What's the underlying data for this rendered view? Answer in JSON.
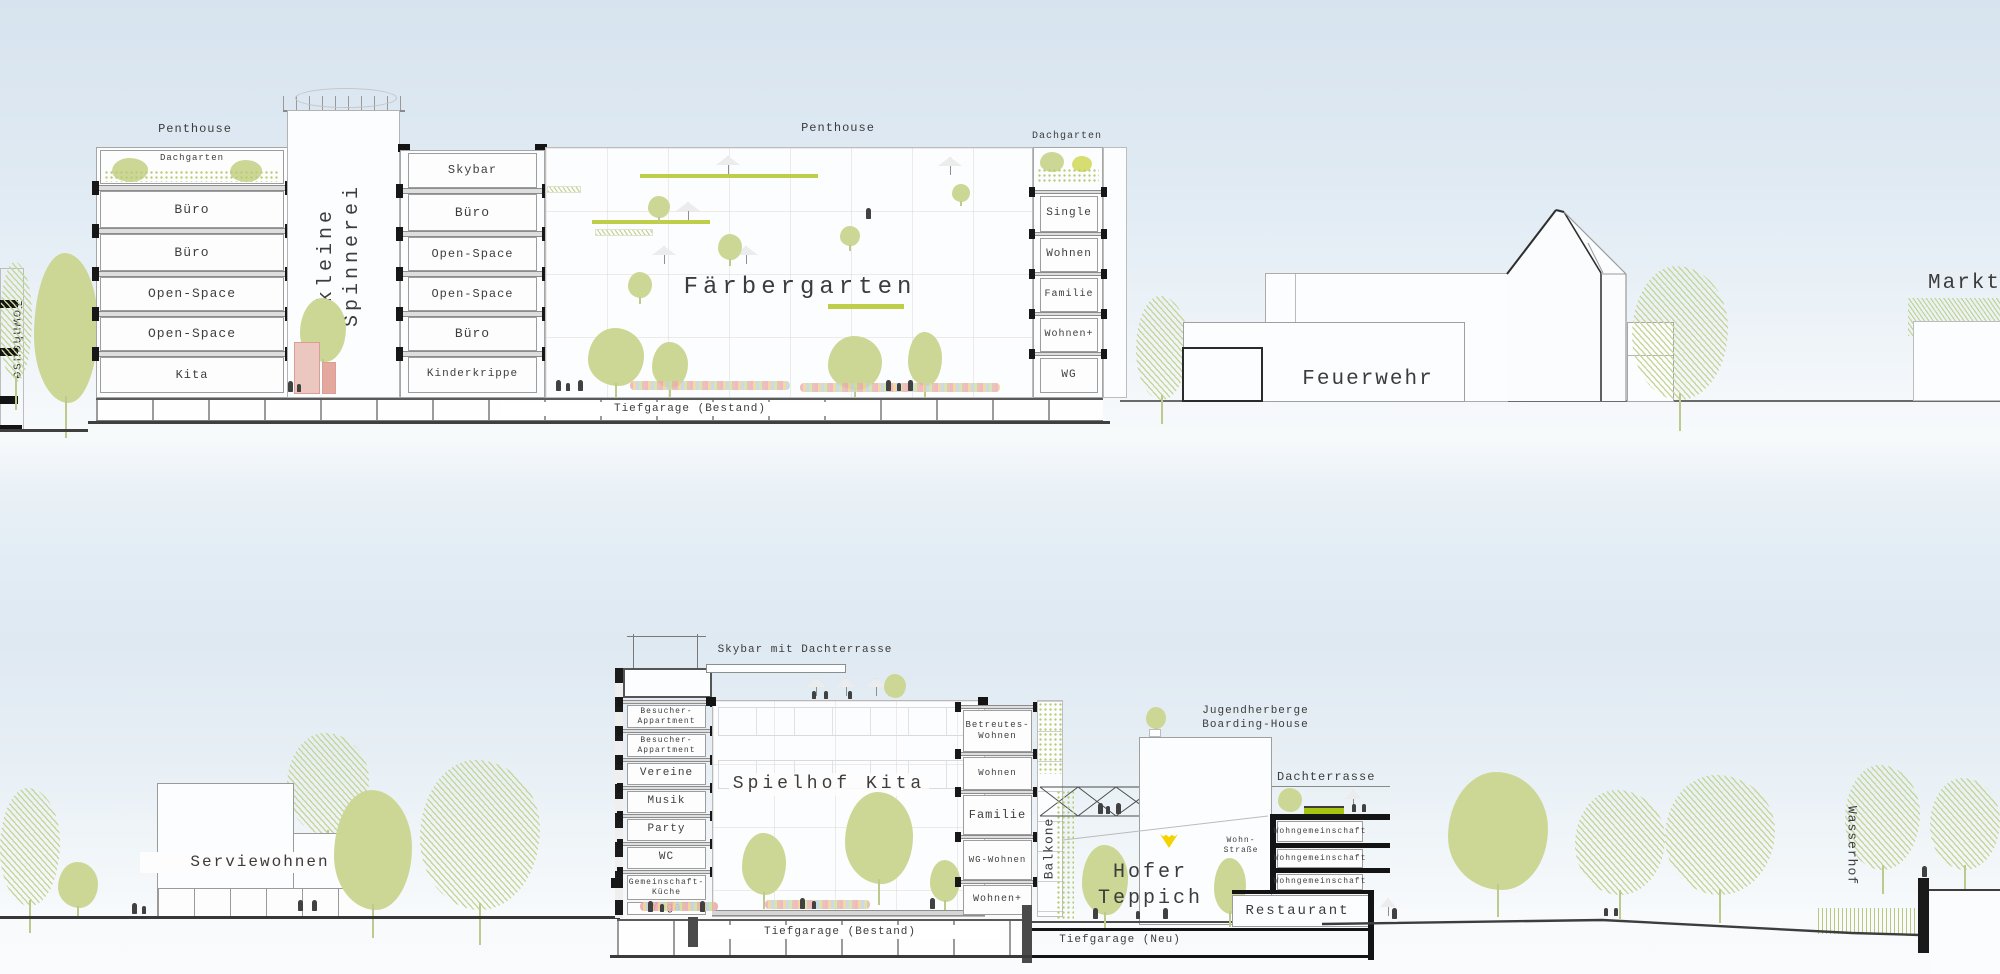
{
  "top": {
    "townhouse": "Townhouse",
    "penthouse_left": "Penthouse",
    "left_tower_floors": [
      "Dachgarten",
      "Büro",
      "Büro",
      "Open-Space",
      "Open-Space",
      "Kita"
    ],
    "spinnerei": "kleine\nSpinnerei",
    "mid_tower_floors": [
      "Skybar",
      "Büro",
      "Open-Space",
      "Open-Space",
      "Büro",
      "Kinderkrippe"
    ],
    "penthouse_center": "Penthouse",
    "hall": "Färbergarten",
    "dachgarten_right": "Dachgarten",
    "right_tower_floors": [
      "Single",
      "Wohnen",
      "Familie",
      "Wohnen+",
      "WG"
    ],
    "tiefgarage": "Tiefgarage (Bestand)",
    "feuerwehr": "Feuerwehr",
    "markt": "Markt"
  },
  "bottom": {
    "serviewohnen": "Serviewohnen",
    "skybar": "Skybar mit Dachterrasse",
    "left_tower_floors": [
      "Besucher-\nAppartment",
      "Besucher-\nAppartment",
      "Vereine",
      "Musik",
      "Party",
      "WC",
      "Gemeinschaft-\nKüche",
      "Yoga"
    ],
    "hall": "Spielhof Kita",
    "right_tower_floors": [
      "Betreutes-\nWohnen",
      "Wohnen",
      "Familie",
      "WG-Wohnen",
      "Wohnen+"
    ],
    "balkone": "Balkone",
    "tiefgarage_bestand": "Tiefgarage (Bestand)",
    "bruecke": "Brücke",
    "jugendherberge": "Jugendherberge\nBoarding-House",
    "hofer_teppich": "Hofer Teppich",
    "wohnstrasse": "Wohn-\nStraße",
    "dachterrasse": "Dachterrasse",
    "wg_floors": [
      "Wohngemeinschaft",
      "Wohngemeinschaft",
      "Wohngemeinschaft"
    ],
    "restaurant": "Restaurant",
    "tiefgarage_neu": "Tiefgarage (Neu)",
    "wasserhof": "Wasserhof"
  },
  "colors": {
    "sky_top": "#d7e3ee",
    "tree_green": "#ccd795",
    "bar_green": "#bece49",
    "bench_green": "#a7c410",
    "slab_black": "#141414",
    "umbrella_yellow": "#f4d300",
    "text": "#3c3c3c"
  }
}
